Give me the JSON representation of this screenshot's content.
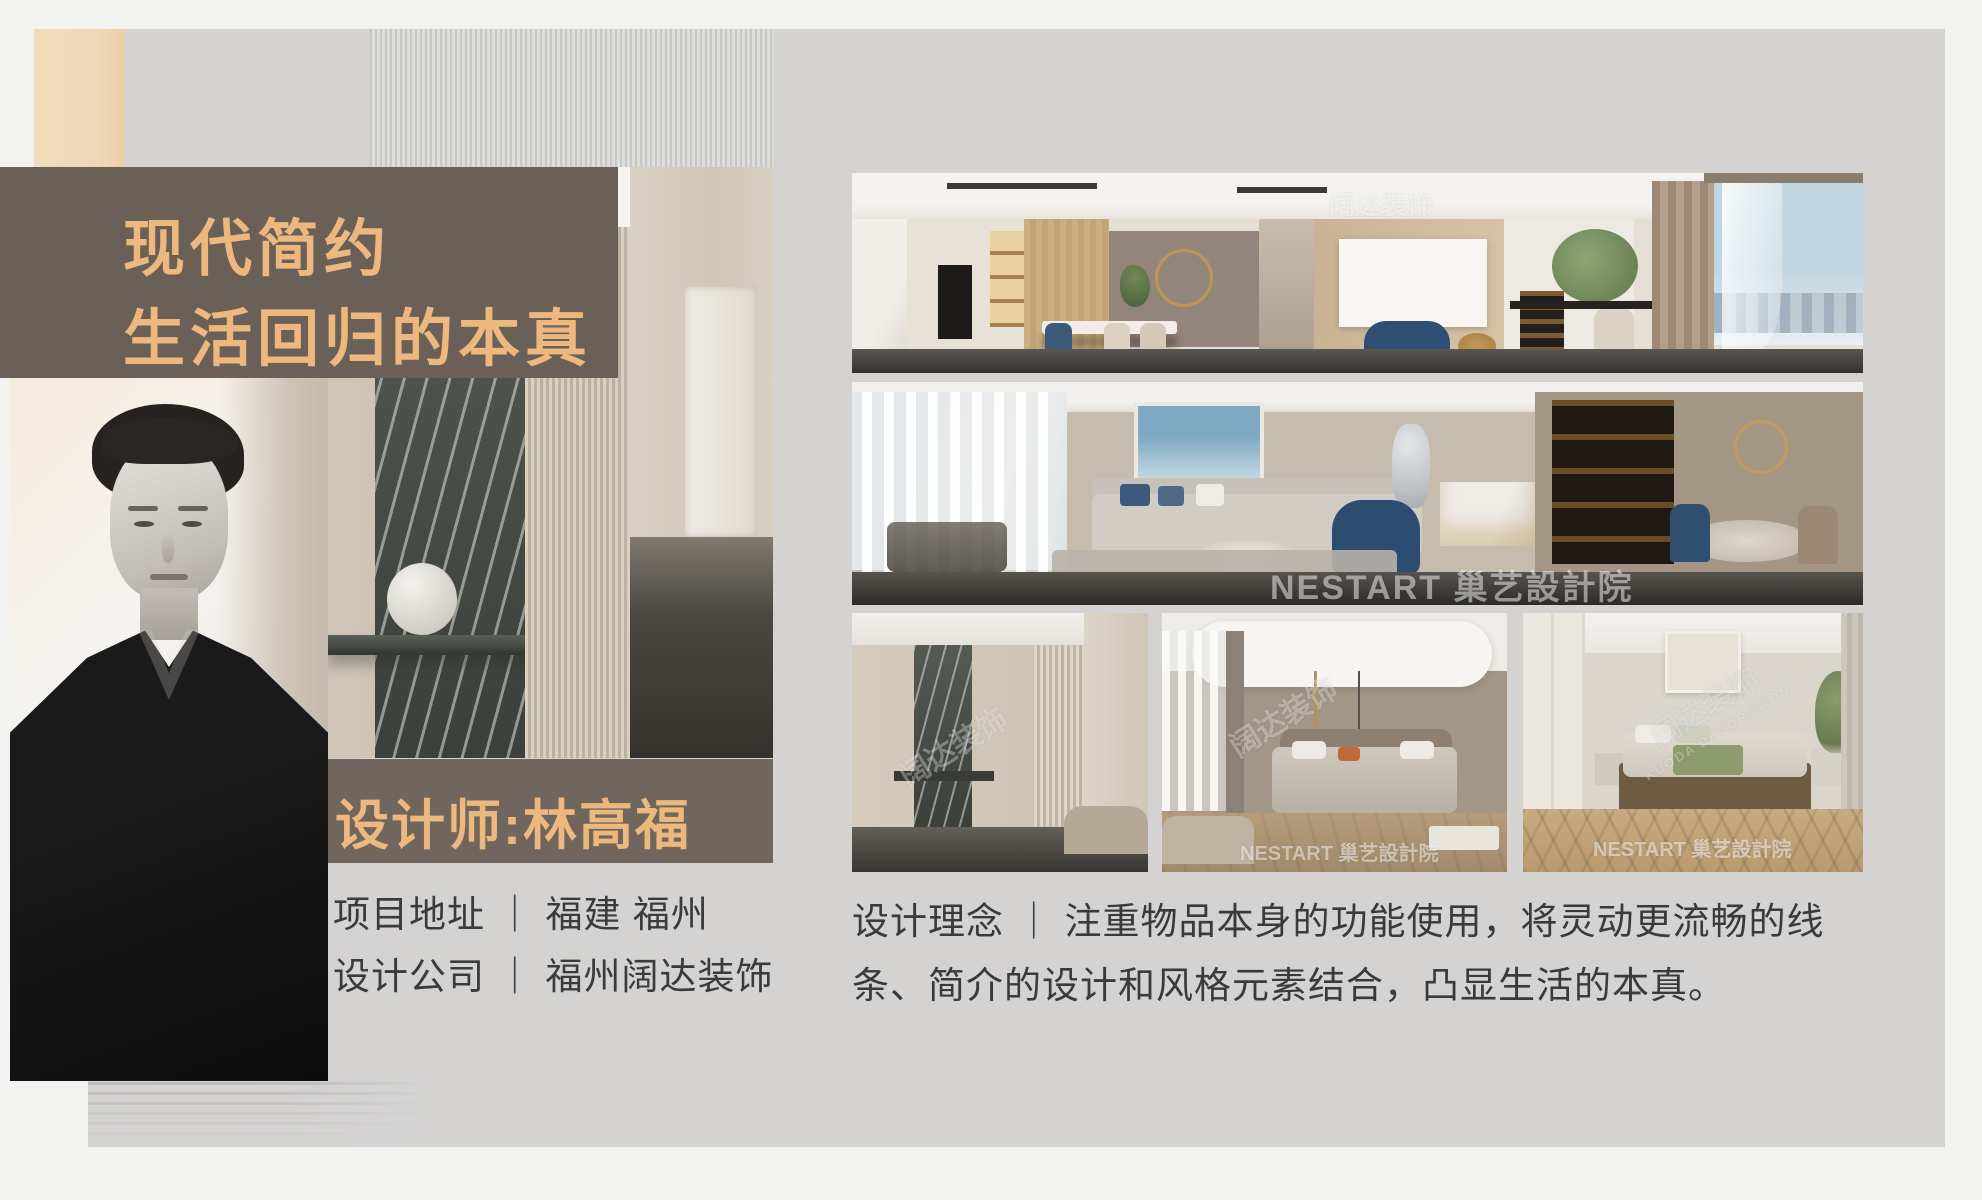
{
  "page": {
    "background": "#f2f2f1",
    "card_background": "#d4d3d2",
    "accent_tan": "#eed8b6",
    "accent_brown": "#6a6057",
    "accent_orange": "#edb87e"
  },
  "title_block": {
    "line1": "现代简约",
    "line2": "生活回归的本真"
  },
  "designer": {
    "badge_label": "设计师:林高福"
  },
  "project_info": {
    "address": "项目地址 ｜ 福建 福州",
    "company": "设计公司 ｜ 福州阔达装饰"
  },
  "concept": {
    "text": "设计理念 ｜ 注重物品本身的功能使用，将灵动更流畅的线条、简介的设计和风格元素结合，凸显生活的本真。"
  },
  "watermarks": {
    "studio": "NESTART 巢艺設計院",
    "brand": "阔达装饰",
    "brand_en": "KUODA DECORATION"
  }
}
